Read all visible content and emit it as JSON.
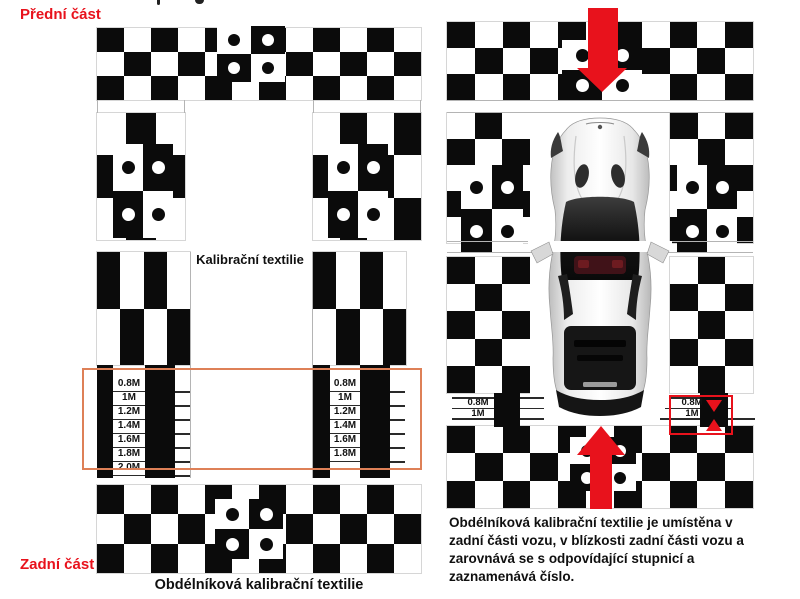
{
  "labels": {
    "front": "Přední část",
    "rear": "Zadní část",
    "calibration": "Kalibrační textilie",
    "caption": "Obdélníková kalibrační textilie",
    "note": "Obdélníková kalibrační textilie je umístěna v zadní části vozu, v blízkosti zadní části vozu a zarovnává se s odpovídající stupnicí a zaznamenává číslo."
  },
  "scales": {
    "left_strip": [
      "0.8M",
      "1M",
      "1.2M",
      "1.4M",
      "1.6M",
      "1.8M",
      "2.0M"
    ],
    "right_strip": [
      "0.8M",
      "1M",
      "1.2M",
      "1.4M",
      "1.6M",
      "1.8M"
    ],
    "car_left": [
      "0.8M",
      "1M"
    ],
    "car_right": [
      "0.8M",
      "1M"
    ]
  },
  "colors": {
    "red": "#e8121c",
    "orange_box": "#de8057",
    "black": "#0b0b0b",
    "label_red": "#e8121c"
  }
}
